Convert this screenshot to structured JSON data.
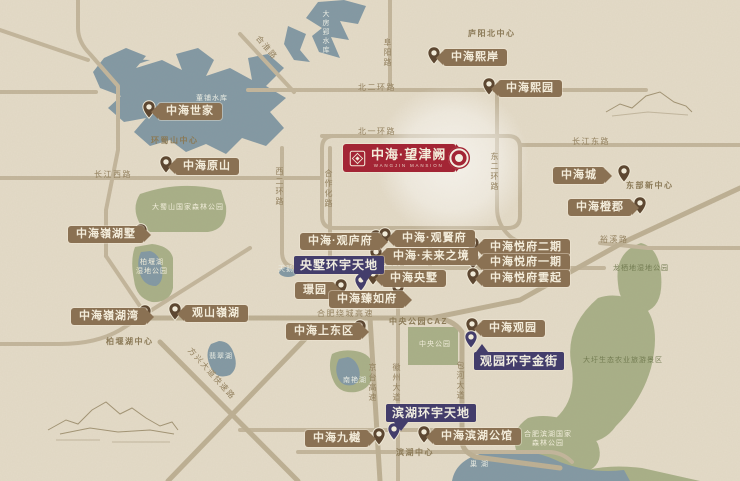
{
  "colors": {
    "background": "#e4dbc8",
    "water": "#8399a4",
    "park": "#a9b088",
    "road": "#c3b69c",
    "highway": "#bdb094",
    "badge_brown": "#8a7153",
    "badge_purple": "#433d6b",
    "badge_red": "#a32535",
    "pin_brown": "#5d4731",
    "pin_purple": "#433d6b",
    "cream": "#f3ecda"
  },
  "main_project": {
    "name": "中海·望津阙",
    "subtitle": "WANGJIN MANSION",
    "x": 343,
    "y": 144,
    "target_x": 447,
    "target_y": 146
  },
  "properties": [
    {
      "label": "中海世家",
      "x": 158,
      "y": 103,
      "arrow": "left",
      "px": 149,
      "py": 108
    },
    {
      "label": "中海原山",
      "x": 175,
      "y": 158,
      "arrow": "left",
      "px": 166,
      "py": 163
    },
    {
      "label": "中海熙岸",
      "x": 443,
      "y": 49,
      "arrow": "left",
      "px": 434,
      "py": 54
    },
    {
      "label": "中海熙园",
      "x": 498,
      "y": 80,
      "arrow": "left",
      "px": 489,
      "py": 85
    },
    {
      "label": "中海城",
      "x": 553,
      "y": 167,
      "arrow": "right",
      "px": 624,
      "py": 172
    },
    {
      "label": "中海橙郡",
      "x": 568,
      "y": 199,
      "arrow": "right",
      "px": 640,
      "py": 204
    },
    {
      "label": "中海·观庐府",
      "x": 300,
      "y": 233,
      "arrow": "right",
      "px": 376,
      "py": 237
    },
    {
      "label": "中海·观賢府",
      "x": 394,
      "y": 230,
      "arrow": "left",
      "px": 385,
      "py": 235
    },
    {
      "label": "中海·未来之境",
      "x": 385,
      "y": 248,
      "arrow": "left",
      "px": 376,
      "py": 253
    },
    {
      "label": "中海央墅",
      "x": 382,
      "y": 270,
      "arrow": "left",
      "px": 373,
      "py": 275
    },
    {
      "label": "璟园",
      "x": 295,
      "y": 282,
      "arrow": "right",
      "px": 341,
      "py": 286
    },
    {
      "label": "中海臻如府",
      "x": 329,
      "y": 291,
      "arrow": "right",
      "px": 398,
      "py": 288
    },
    {
      "label": "中海悦府二期",
      "x": 482,
      "y": 239,
      "arrow": "left",
      "px": 473,
      "py": 244
    },
    {
      "label": "中海悦府一期",
      "x": 482,
      "y": 254,
      "arrow": "left",
      "px": 473,
      "py": 259
    },
    {
      "label": "中海悦府雲起",
      "x": 482,
      "y": 270,
      "arrow": "left",
      "px": 473,
      "py": 275
    },
    {
      "label": "中海嶺湖墅",
      "x": 68,
      "y": 226,
      "arrow": "right",
      "px": 141,
      "py": 231
    },
    {
      "label": "中海嶺湖湾",
      "x": 71,
      "y": 308,
      "arrow": "right",
      "px": 145,
      "py": 312
    },
    {
      "label": "观山嶺湖",
      "x": 184,
      "y": 305,
      "arrow": "left",
      "px": 175,
      "py": 310
    },
    {
      "label": "中海上东区",
      "x": 286,
      "y": 323,
      "arrow": "right",
      "px": 360,
      "py": 327
    },
    {
      "label": "中海观园",
      "x": 481,
      "y": 320,
      "arrow": "left",
      "px": 472,
      "py": 325
    },
    {
      "label": "中海九樾",
      "x": 305,
      "y": 430,
      "arrow": "right",
      "px": 379,
      "py": 435
    },
    {
      "label": "中海滨湖公馆",
      "x": 433,
      "y": 428,
      "arrow": "left",
      "px": 424,
      "py": 433
    }
  ],
  "commercial": [
    {
      "label": "央墅环宇天地",
      "x": 294,
      "y": 256,
      "px": 361,
      "py": 281,
      "tail": "br"
    },
    {
      "label": "滨湖环宇天地",
      "x": 386,
      "y": 404,
      "px": 394,
      "py": 430,
      "tail": "bl"
    },
    {
      "label": "观园环宇金街",
      "x": 474,
      "y": 352,
      "px": 471,
      "py": 338,
      "tail": "tl"
    }
  ],
  "road_labels": [
    {
      "t": "合淮路",
      "x": 252,
      "y": 44,
      "r": 50
    },
    {
      "t": "北二环路",
      "x": 358,
      "y": 84
    },
    {
      "t": "北一环路",
      "x": 358,
      "y": 128
    },
    {
      "t": "阜阳路",
      "x": 383,
      "y": 38,
      "v": true
    },
    {
      "t": "东二环路",
      "x": 490,
      "y": 152,
      "v": true
    },
    {
      "t": "西二环路",
      "x": 275,
      "y": 167,
      "v": true
    },
    {
      "t": "合作化路",
      "x": 324,
      "y": 169,
      "v": true
    },
    {
      "t": "长江西路",
      "x": 94,
      "y": 171
    },
    {
      "t": "长江东路",
      "x": 572,
      "y": 138
    },
    {
      "t": "南二环路",
      "x": 368,
      "y": 259
    },
    {
      "t": "合肥绕城高速",
      "x": 317,
      "y": 310
    },
    {
      "t": "京台高速",
      "x": 368,
      "y": 363,
      "v": true
    },
    {
      "t": "徽州大道",
      "x": 392,
      "y": 363,
      "v": true
    },
    {
      "t": "包河大道",
      "x": 456,
      "y": 361,
      "v": true
    },
    {
      "t": "方兴大道快速路",
      "x": 178,
      "y": 370,
      "r": 48
    },
    {
      "t": "裕溪路",
      "x": 600,
      "y": 236
    }
  ],
  "districts": [
    {
      "t": "庐阳北中心",
      "x": 468,
      "y": 30
    },
    {
      "t": "环蜀山中心",
      "x": 151,
      "y": 137
    },
    {
      "t": "东部新中心",
      "x": 626,
      "y": 182
    },
    {
      "t": "中央公园CAZ",
      "x": 389,
      "y": 318
    },
    {
      "t": "滨湖中心",
      "x": 396,
      "y": 449
    },
    {
      "t": "柏堰湖中心",
      "x": 106,
      "y": 338
    }
  ],
  "water_labels": [
    {
      "t": "董铺水库",
      "x": 196,
      "y": 95
    },
    {
      "t": "大房郢水库",
      "x": 322,
      "y": 10,
      "v": true
    },
    {
      "t": "天鹅湖",
      "x": 278,
      "y": 266
    },
    {
      "t": "翡翠湖",
      "x": 209,
      "y": 353
    },
    {
      "t": "南艳湖",
      "x": 343,
      "y": 377
    },
    {
      "t": "巢  湖",
      "x": 470,
      "y": 461
    }
  ],
  "park_labels": [
    {
      "lines": [
        "大蜀山国家森林公园"
      ],
      "x": 152,
      "y": 203
    },
    {
      "lines": [
        "柏堰湖",
        "湿地公园"
      ],
      "x": 136,
      "y": 258
    },
    {
      "lines": [
        "中央公园"
      ],
      "x": 419,
      "y": 340
    },
    {
      "lines": [
        "大圩生态农业旅游景区"
      ],
      "x": 583,
      "y": 356,
      "dark": true
    },
    {
      "lines": [
        "龙栖地湿地公园"
      ],
      "x": 613,
      "y": 264,
      "dark": true
    },
    {
      "lines": [
        "合肥滨湖国家",
        "森林公园"
      ],
      "x": 524,
      "y": 430
    }
  ]
}
